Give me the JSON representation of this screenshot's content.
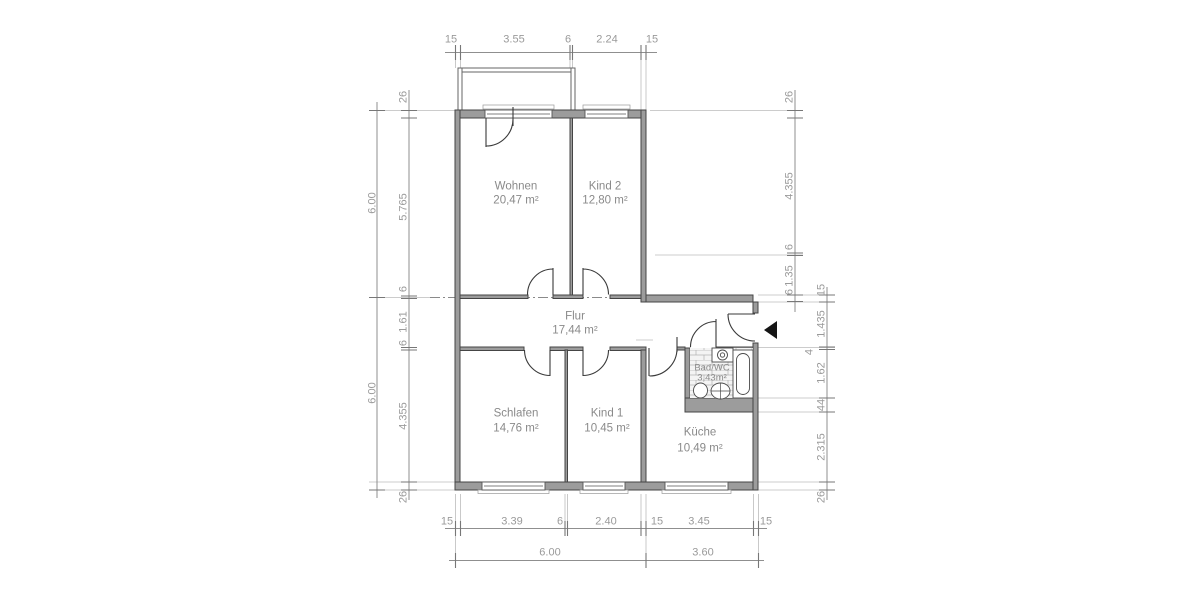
{
  "rooms": [
    {
      "id": "wohnen",
      "name": "Wohnen",
      "area": "20,47 m²"
    },
    {
      "id": "kind2",
      "name": "Kind 2",
      "area": "12,80 m²"
    },
    {
      "id": "flur",
      "name": "Flur",
      "area": "17,44 m²"
    },
    {
      "id": "schlafen",
      "name": "Schlafen",
      "area": "14,76 m²"
    },
    {
      "id": "kind1",
      "name": "Kind 1",
      "area": "10,45 m²"
    },
    {
      "id": "badwc",
      "name": "Bad/WC",
      "area": "3,43m²"
    },
    {
      "id": "kueche",
      "name": "Küche",
      "area": "10,49 m²"
    }
  ],
  "dimensions": {
    "top": [
      "15",
      "3.55",
      "6",
      "2.24",
      "15"
    ],
    "left_outer": [
      "6.00",
      "6.00"
    ],
    "left_inner": [
      "26",
      "5.765",
      "6",
      "1.61",
      "6",
      "4.355",
      "26"
    ],
    "right_col1": [
      "26",
      "4.355",
      "6",
      "1.35",
      "6"
    ],
    "right_col2": [
      "15",
      "1.435",
      "4",
      "1.62",
      "44",
      "2.315",
      "26"
    ],
    "bottom_detail": [
      "15",
      "3.39",
      "6",
      "2.40",
      "15",
      "3.45",
      "15"
    ],
    "bottom_overall": [
      "6.00",
      "3.60"
    ]
  },
  "colors": {
    "wall_fill": "#9c9c9c",
    "wall_edge": "#454545",
    "dimension_text": "#9a9a9a",
    "room_text": "#8a8a8a",
    "door_line": "#3a3a3a",
    "entrance_marker": "#151515"
  }
}
